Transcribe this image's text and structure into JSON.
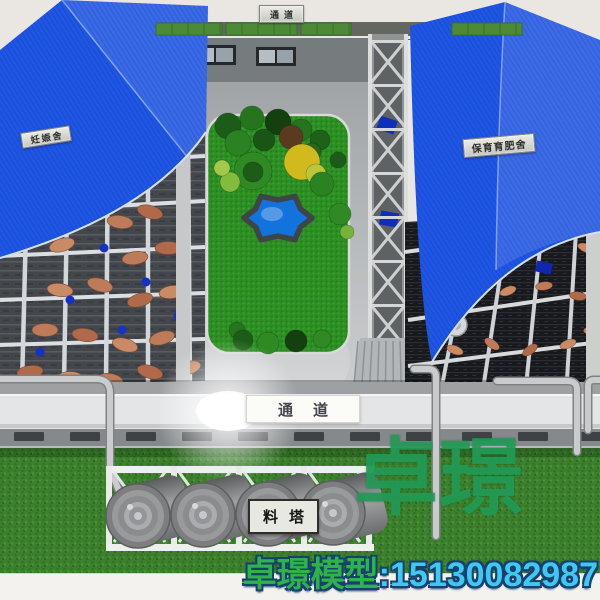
{
  "signs": {
    "top_passage": "通道",
    "left_barn": "妊娠舍",
    "right_barn": "保育育肥舍",
    "corridor_passage": "通道",
    "feed_tower": "料塔"
  },
  "watermark": "卓璟",
  "caption": {
    "brand": "卓璟模型",
    "phone": ":15130082987"
  },
  "colors": {
    "roof_blue": "#1e56e6",
    "grass_green": "#3c802d",
    "garden_green": "#2c8f23",
    "pond_blue": "#1273dd",
    "watermark_green": "#229c56",
    "caption_brand_green": "#2eb34a",
    "caption_phone_cyan": "#3ec9f2",
    "caption_outline_navy": "#16406e"
  }
}
